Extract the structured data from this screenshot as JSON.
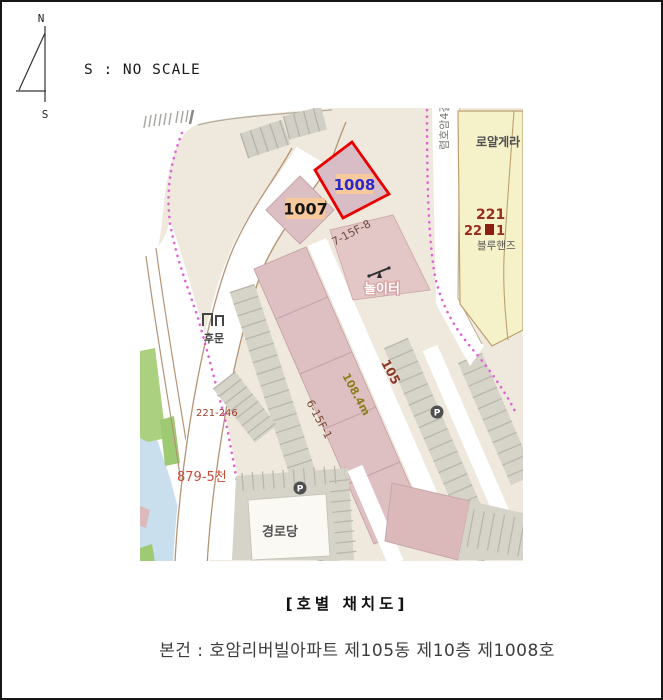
{
  "compass": {
    "north": "N",
    "south": "S"
  },
  "header": {
    "scale_note": "S : NO SCALE"
  },
  "map": {
    "unit_labels": {
      "u1007": "1007",
      "u1008": "1008"
    },
    "annotations": {
      "code_7_15f_8": "7-15F-8",
      "playground": "놀이터",
      "block_105": "105",
      "length_108_4m": "108.4m",
      "code_6_15f_1": "6-15F-1",
      "back_gate": "후문",
      "parcel_221_246": "221-246",
      "parcel_879_5": "879-5천",
      "senior_center": "경로당",
      "royal_building": "로얄게라",
      "parcel_221": "221",
      "parcel_221_sub_prefix": "22",
      "parcel_221_sub_suffix": "1",
      "bluehands": "블루핸즈",
      "street_name": "렴호암4길",
      "parking": "P"
    },
    "colors": {
      "highlight_outline": "#e80000",
      "unit_label_bg": "#f9c99e",
      "u1008_text": "#2929cf",
      "u1007_text": "#151515",
      "building_fill": "#dec0c2",
      "land": "#efe9dd",
      "parcel_yellow": "#f5f1c9",
      "water": "#c9dfee",
      "green": "#abd07f",
      "boundary_dot": "#e161d3"
    }
  },
  "caption": {
    "title": "[호별 채치도]",
    "subject": "본건 : 호암리버빌아파트 제105동 제10층 제1008호"
  }
}
